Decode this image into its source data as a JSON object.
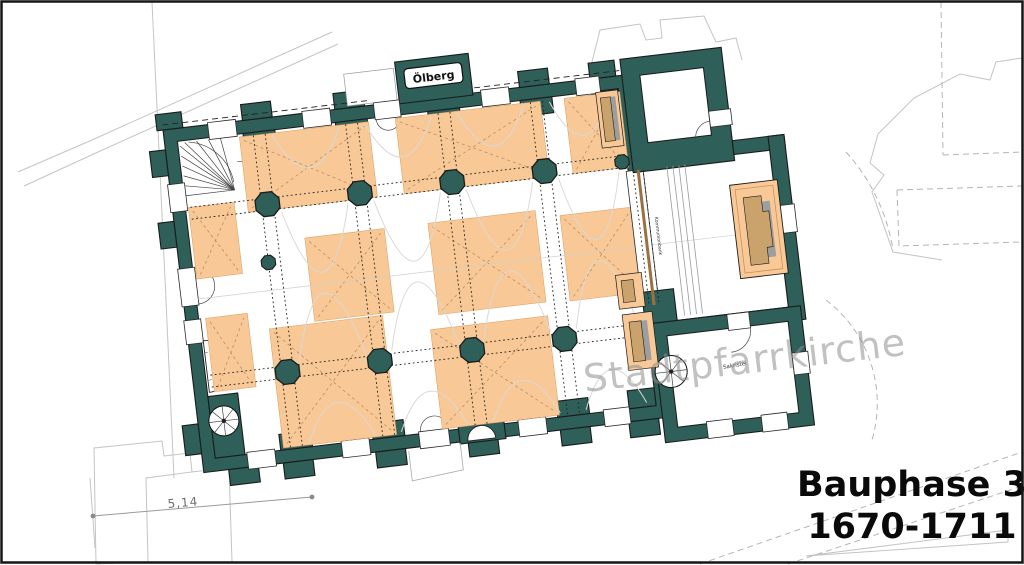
{
  "drawing": {
    "watermark": "Stadtpfarrkirche",
    "phase_title": {
      "line1": "Bauphase 3",
      "line2": "1670-1711"
    },
    "labels": {
      "oelberg": "Ölberg",
      "sakristei": "Sakristei",
      "kommunionbank": "Kommunionbank"
    },
    "dimension": {
      "value": "5,14"
    },
    "colors": {
      "wall": "#2E5F58",
      "phase_highlight": "#F8C997",
      "altar_wood": "#C9A36B",
      "shadow": "#9E9E9E",
      "site_outline": "#C4C4C4",
      "watermark": "#8F8F8F",
      "frame": "#151515",
      "paper": "#FFFFFF"
    }
  }
}
